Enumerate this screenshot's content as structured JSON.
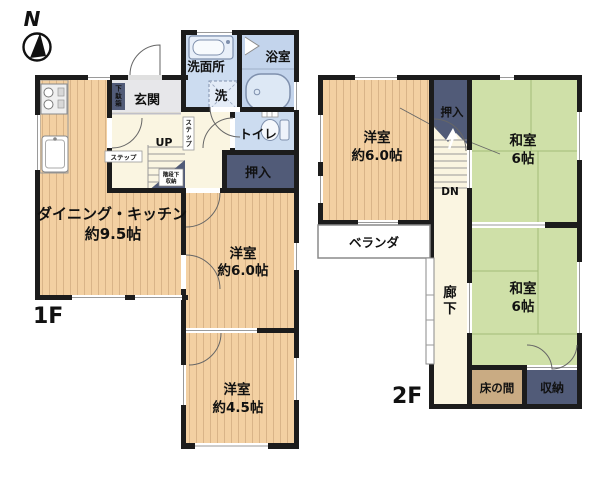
{
  "compass": {
    "north_label": "N"
  },
  "floor1": {
    "label": "1F",
    "dk_name": "ダイニング・キッチン",
    "dk_size": "約9.5帖",
    "western6_name": "洋室",
    "western6_size": "約6.0帖",
    "western45_name": "洋室",
    "western45_size": "約4.5帖",
    "entrance": "玄関",
    "shoe_cabinet": "下駄箱",
    "washroom": "洗面所",
    "washer": "洗",
    "bathroom": "浴室",
    "toilet": "トイレ",
    "closet": "押入",
    "stairs_up": "UP",
    "step_a": "ステップ",
    "step_b": "ステップ",
    "under_stairs_row1": "階段下",
    "under_stairs_row2": "収納"
  },
  "floor2": {
    "label": "2F",
    "western6_name": "洋室",
    "western6_size": "約6.0帖",
    "japanese1_name": "和室",
    "japanese1_size": "6帖",
    "japanese2_name": "和室",
    "japanese2_size": "6帖",
    "closet": "押入",
    "stairs_down": "DN",
    "corridor": "廊下",
    "veranda": "ベランダ",
    "tokonoma": "床の間",
    "storage": "収納"
  },
  "colors": {
    "wall": "#1c1c1c",
    "wood_floor": "#f3d0a2",
    "wood_stripe": "#d9b488",
    "tatami": "#cfe0a8",
    "tatami_line": "#a3bb79",
    "closet_navy": "#515b78",
    "tokonoma_tan": "#c9ab83",
    "water_blue": "#ccdcf0",
    "bath_blue": "#c3d4ec",
    "hall_cream": "#faf5e1",
    "genkan_gray": "#e7e7ea"
  }
}
